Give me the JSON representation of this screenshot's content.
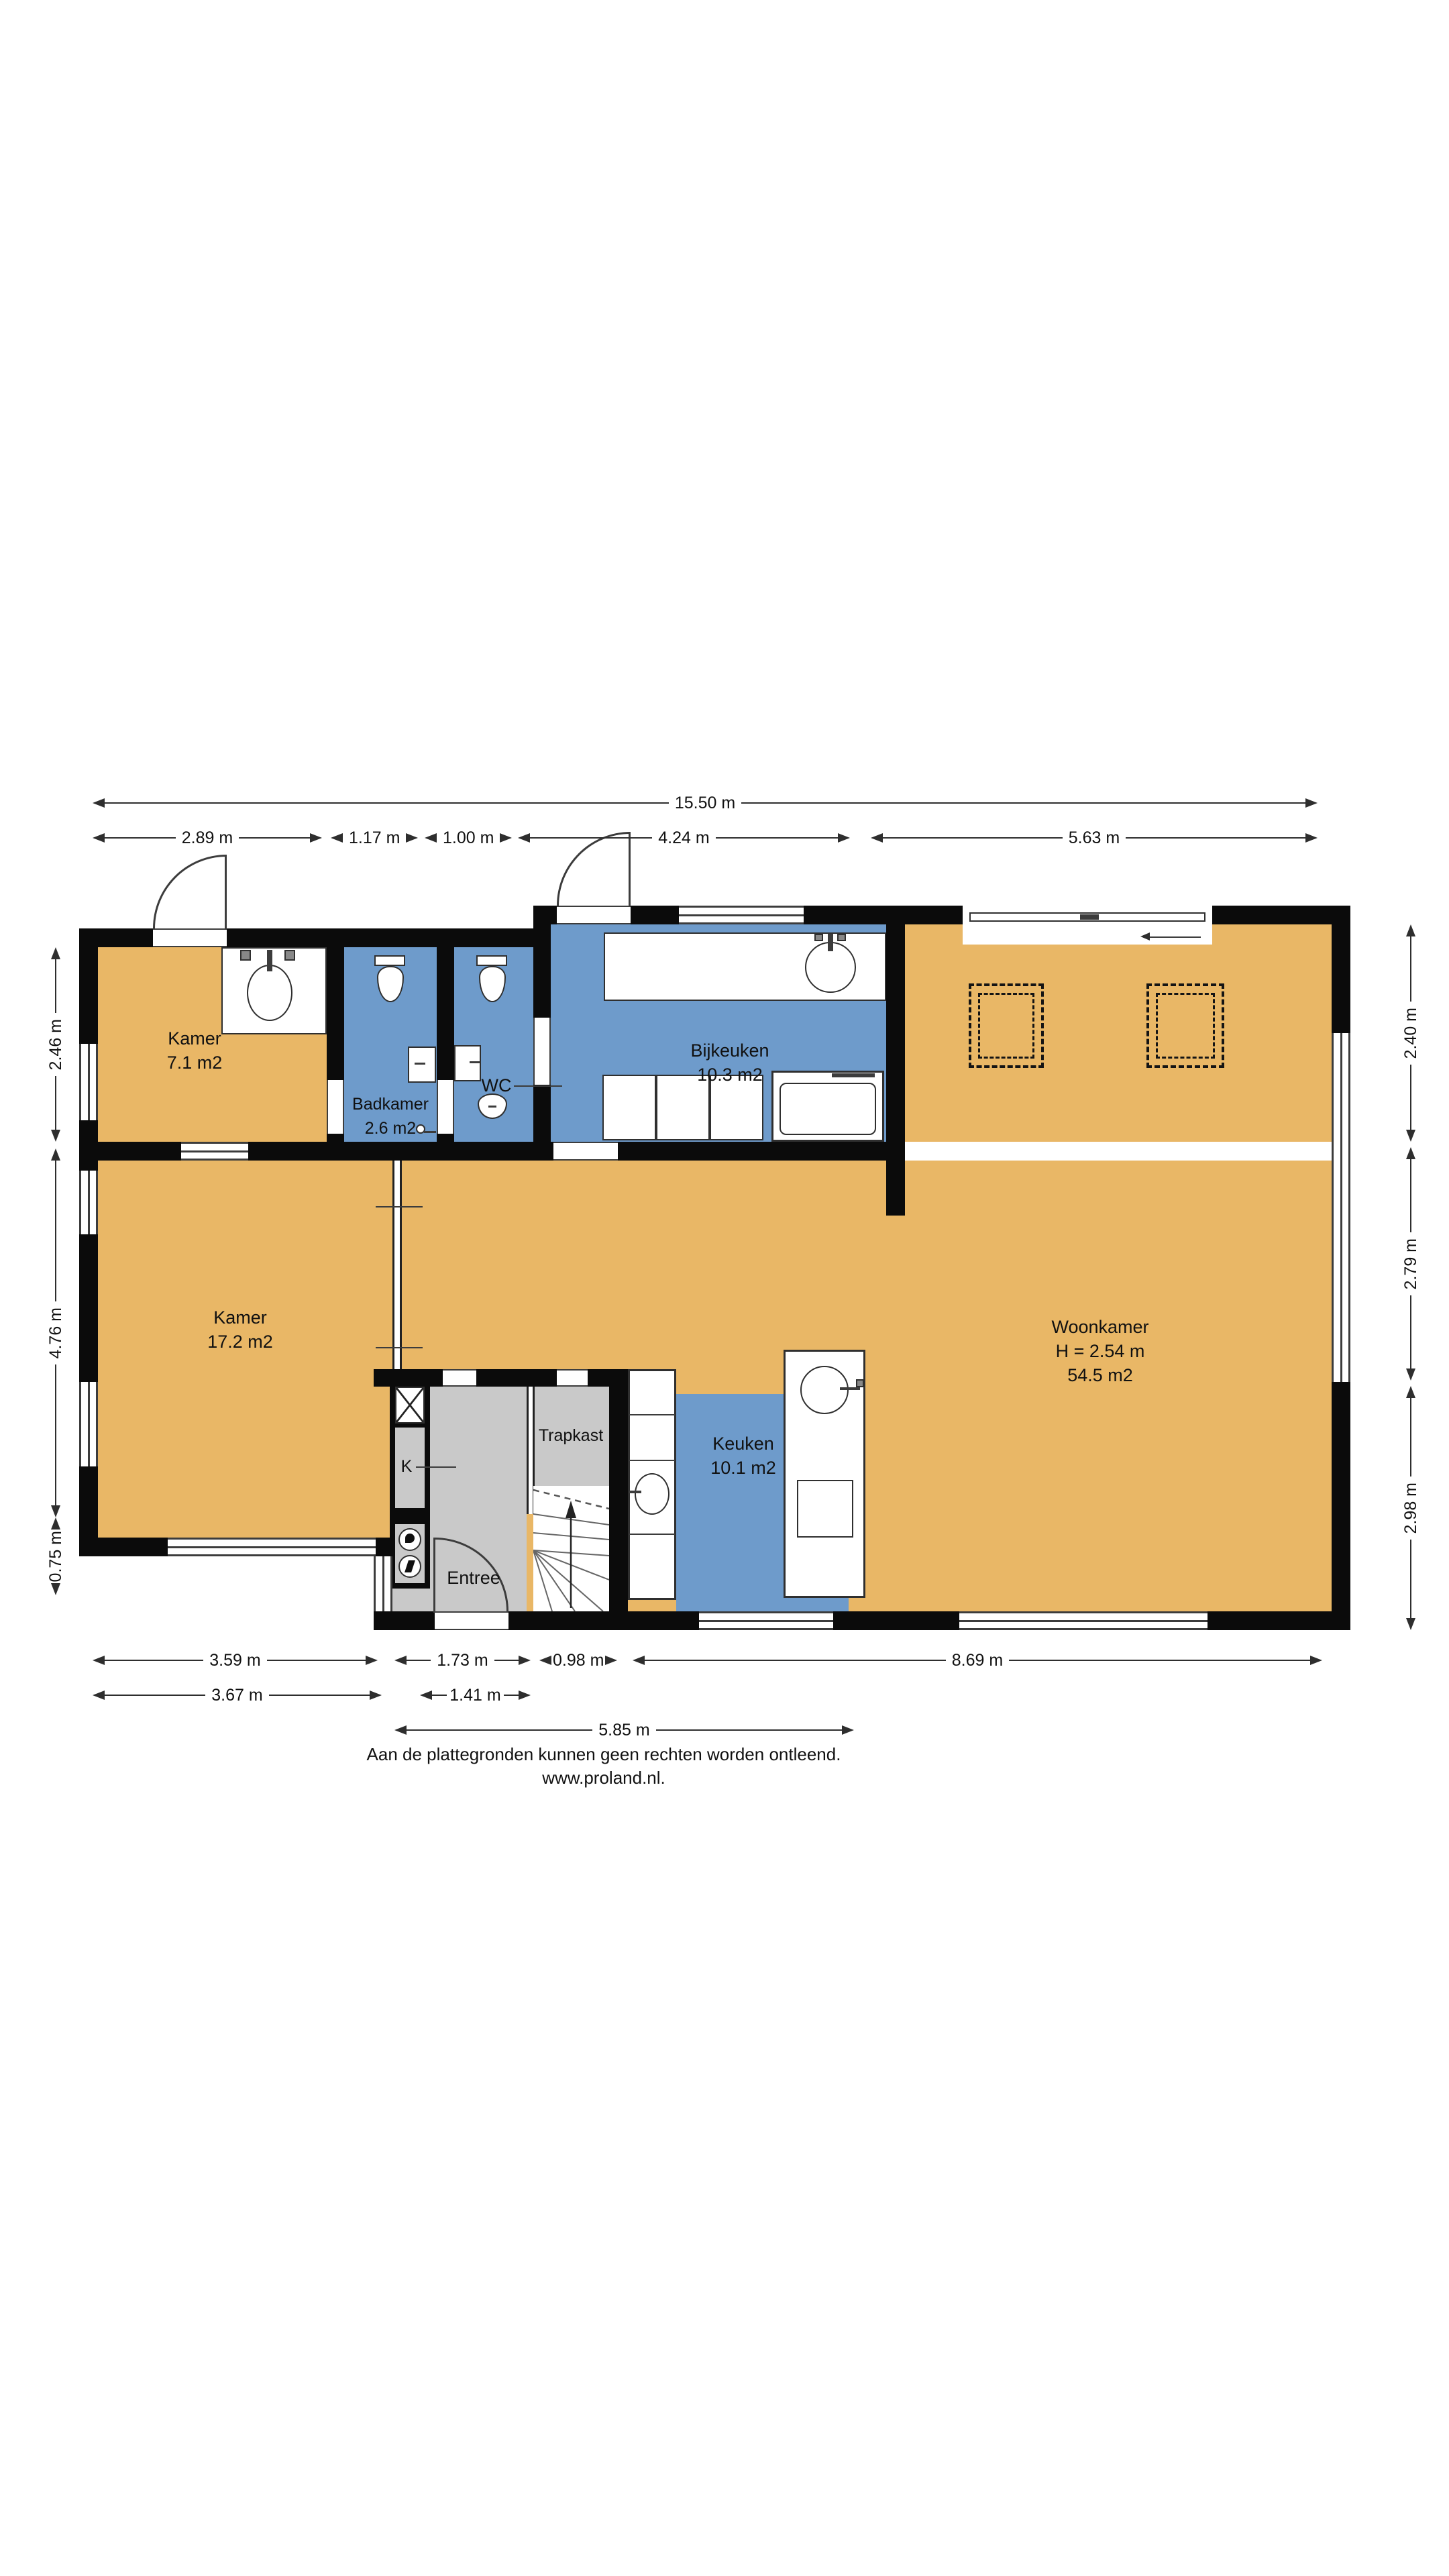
{
  "rooms": {
    "kamer_klein": {
      "name": "Kamer",
      "area": "7.1 m2"
    },
    "badkamer": {
      "name": "Badkamer",
      "area": "2.6 m2"
    },
    "wc": {
      "name": "WC"
    },
    "bijkeuken": {
      "name": "Bijkeuken",
      "area": "10.3 m2"
    },
    "woonkamer": {
      "name": "Woonkamer",
      "height": "H = 2.54 m",
      "area": "54.5 m2"
    },
    "kamer_groot": {
      "name": "Kamer",
      "area": "17.2 m2"
    },
    "keuken": {
      "name": "Keuken",
      "area": "10.1 m2"
    },
    "entree": {
      "name": "Entree"
    },
    "trapkast": {
      "name": "Trapkast"
    },
    "kast": {
      "name": "K"
    }
  },
  "dimensions": {
    "top_total": "15.50 m",
    "top": [
      "2.89 m",
      "1.17 m",
      "1.00 m",
      "4.24 m",
      "5.63 m"
    ],
    "bottom": [
      "3.59 m",
      "1.73 m",
      "0.98 m",
      "8.69 m"
    ],
    "bottom2": [
      "3.67 m",
      "1.41 m"
    ],
    "bottom3": "5.85 m",
    "left": [
      "2.46 m",
      "4.76 m",
      "0.75 m"
    ],
    "right": [
      "2.40 m",
      "2.79 m",
      "2.98 m"
    ],
    "right_total": "8.58 m"
  },
  "footer": {
    "disclaimer": "Aan de plattegronden kunnen geen rechten worden ontleend.",
    "website": "www.proland.nl."
  },
  "colors": {
    "room_orange": "#E9B766",
    "room_blue": "#6E9BCB",
    "room_gray": "#C9C9C9",
    "wall": "#0b0b0b"
  }
}
